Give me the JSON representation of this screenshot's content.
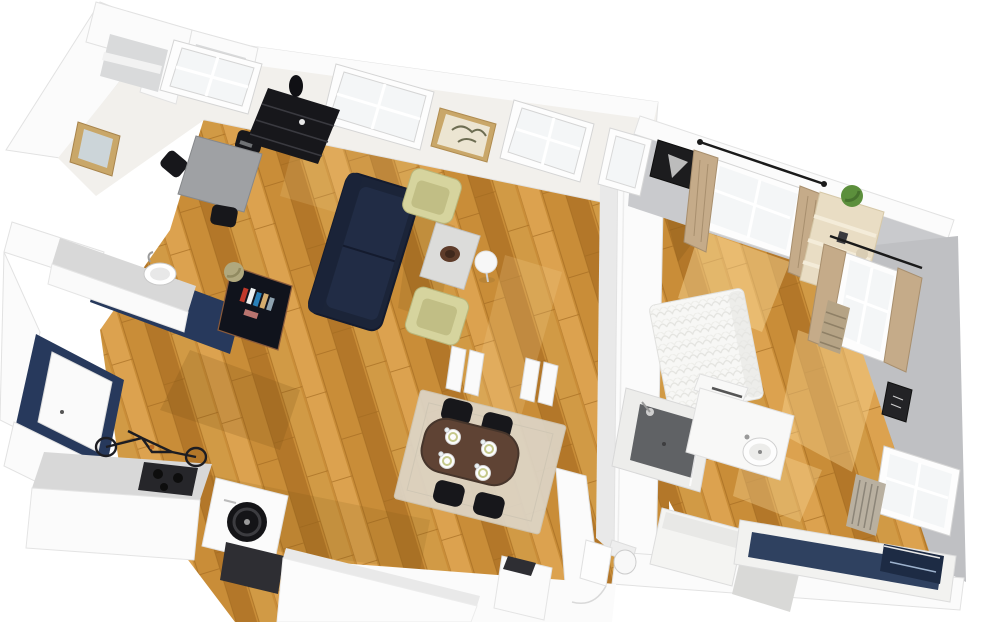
{
  "scene": {
    "title": "3D apartment floor plan",
    "description": "Isometric cutaway 3D rendering of a one-bedroom apartment with warm wood flooring, white cut walls, navy accent walls, living-dining room, kitchen, bedroom and bathroom",
    "view": "3d-cutaway-perspective",
    "background": "#ffffff"
  },
  "colors": {
    "bg": "#ffffff",
    "wall_top": "#fbfbfb",
    "wall_face": "#f2f0ec",
    "wall_gray": "#c9cacd",
    "wall_gray_dark": "#bfc0c3",
    "wall_inner": "#d9dadb",
    "wood_light": "#dca24f",
    "wood_mid": "#c98d38",
    "wood_mid2": "#d19a45",
    "wood_dark": "#b37729",
    "wood_seam": "#a2691f",
    "sun": "#f6d391",
    "shadow": "#6e4a12",
    "navy_wall": "#27395c",
    "navy_sofa": "#1b2438",
    "navy_sofa_hi": "#263351",
    "navy_tub": "#2f4160",
    "navy_tub_dark": "#1d2b44",
    "armchair": "#d6d49e",
    "armchair_dark": "#b9b77c",
    "gray_desk": "#9fa1a4",
    "black_furn": "#17171b",
    "rug": "#ddd5c6",
    "table_brown": "#5f4334",
    "frame_gold": "#c9a769",
    "curtain": "#c5ab89",
    "shelf_cream": "#e9ddc4",
    "plant_green": "#5c8f3c",
    "olive": "#b0a87e",
    "shower_floor": "#606265",
    "counter_gray": "#d8d8d8",
    "appliance_dark": "#2b2b2e",
    "glass": "#f4f6f7",
    "mirror_glass": "#ccd5d9"
  },
  "rooms": [
    {
      "name": "living-room",
      "furniture": [
        "navy two-seat sofa",
        "pale green armchair x2",
        "coffee table with brown bowl",
        "sphere floor lamp",
        "black etagere shelf",
        "botanical wall art",
        "white pedestals x4"
      ]
    },
    {
      "name": "dining-area",
      "furniture": [
        "dark wood oval table",
        "black chairs x4",
        "place settings x4",
        "beige rug"
      ]
    },
    {
      "name": "office-corner",
      "furniture": [
        "gray desk",
        "black chairs x3",
        "gold framed mirror"
      ]
    },
    {
      "name": "kitchen",
      "furniture": [
        "navy accent wall",
        "white door",
        "counter with sink",
        "island with cooktop",
        "washing machine",
        "oven",
        "long white counter",
        "bicycle"
      ]
    },
    {
      "name": "entry",
      "furniture": [
        "navy console with books",
        "olive sphere vase"
      ]
    },
    {
      "name": "bedroom",
      "furniture": [
        "white bed with rumpled duvet",
        "curtained window x2",
        "cream ladder shelf with plant",
        "black framed art x2",
        "tan radiator"
      ]
    },
    {
      "name": "bathroom",
      "furniture": [
        "walk-in shower",
        "vanity with round sink",
        "toilet",
        "navy bathtub",
        "white dresser",
        "window with radiator",
        "side cabinet"
      ]
    }
  ]
}
